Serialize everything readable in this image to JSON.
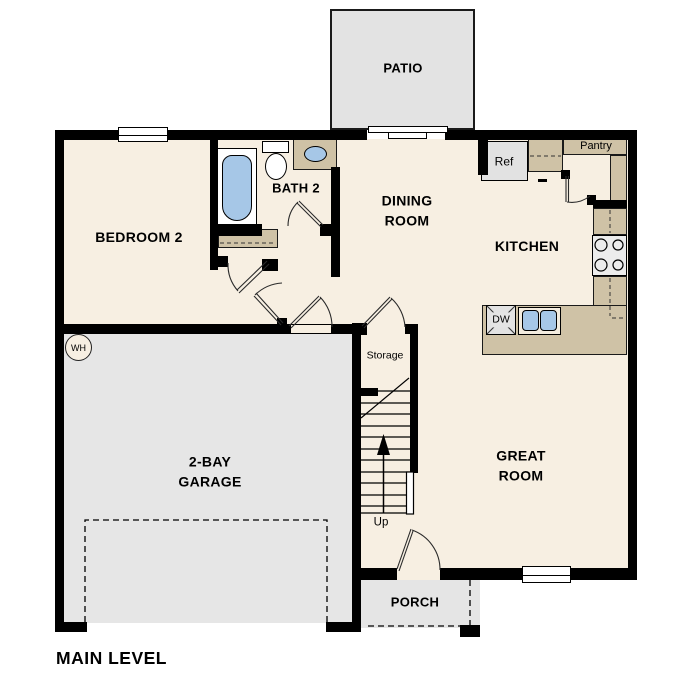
{
  "colors": {
    "wall": "#000000",
    "floor": "#f7efe2",
    "outdoor": "#e4e4e4",
    "garage": "#e6e6e6",
    "counter": "#cfc2a6",
    "blue": "#a6c7e7",
    "appliance": "#e4e4e4",
    "line": "#1a1a1a"
  },
  "rooms": {
    "patio": "PATIO",
    "bedroom2": "BEDROOM 2",
    "bath2": "BATH 2",
    "dining": "DINING\nROOM",
    "kitchen": "KITCHEN",
    "great": "GREAT\nROOM",
    "garage": "2-BAY\nGARAGE",
    "porch": "PORCH",
    "storage": "Storage"
  },
  "fixtures": {
    "ref": "Ref",
    "pantry": "Pantry",
    "dw": "DW",
    "wh": "WH",
    "up": "Up"
  },
  "footer": {
    "main_level": "MAIN LEVEL"
  }
}
